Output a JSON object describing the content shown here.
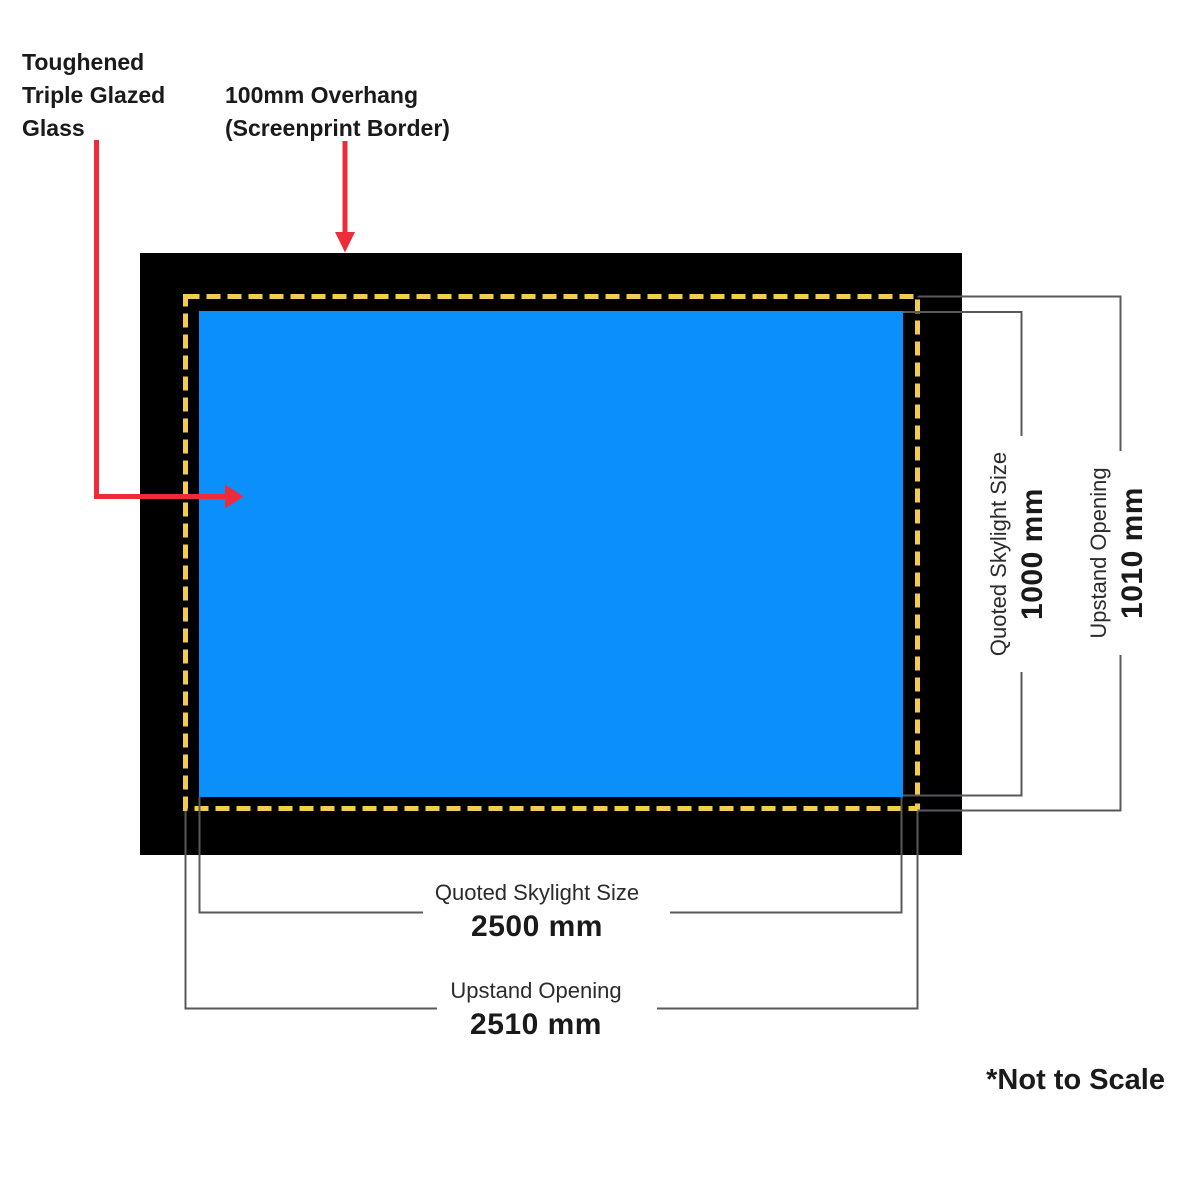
{
  "colors": {
    "background": "#FFFFFF",
    "frame_black": "#000000",
    "glass_blue": "#0A8FFB",
    "dash_yellow": "#F3CC4D",
    "arrow_red": "#EE2B38",
    "dim_line_gray": "#58595B",
    "text_black": "#1A1A1A"
  },
  "callouts": {
    "glass": "Toughened\nTriple Glazed\nGlass",
    "overhang": "100mm Overhang\n(Screenprint Border)"
  },
  "dimensions": {
    "right_inner": {
      "label": "Quoted Skylight Size",
      "value": "1000 mm"
    },
    "right_outer": {
      "label": "Upstand Opening",
      "value": "1010 mm"
    },
    "bottom_inner": {
      "label": "Quoted Skylight Size",
      "value": "2500 mm"
    },
    "bottom_outer": {
      "label": "Upstand Opening",
      "value": "2510 mm"
    }
  },
  "notes": {
    "not_to_scale": "*Not to Scale"
  }
}
